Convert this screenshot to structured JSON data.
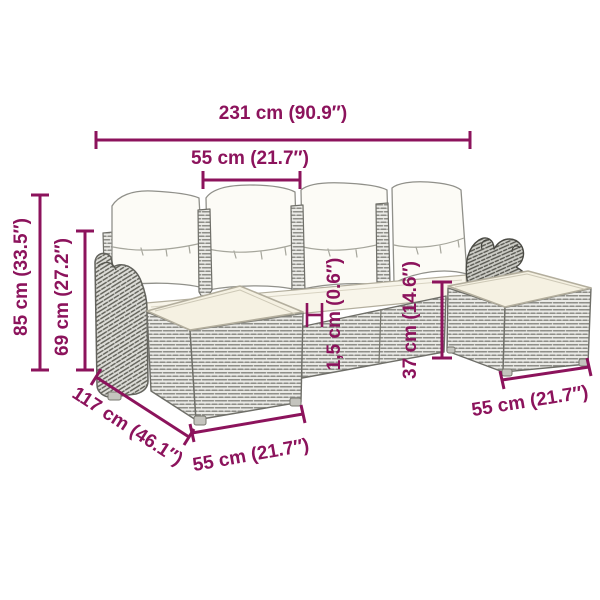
{
  "diagram": {
    "subject": "U-shaped poly rattan garden sofa set with 4 back pillows, seat cushions and 2 ottomans — dimension drawing",
    "background_color": "#ffffff",
    "accent_color": "#8C135C",
    "wicker_line_color": "#8e8e88",
    "cushion_color": "#f5f1e2",
    "pillow_color": "#fcfbf6"
  },
  "labels": {
    "overall_width": "231 cm (90.9″)",
    "seat_width": "55 cm (21.7″)",
    "total_height": "85 cm (33.5″)",
    "back_height": "69 cm (27.2″)",
    "cushion_thickness": "1,5 cm (0.6″)",
    "seat_height": "37 cm (14.6″)",
    "depth": "117 cm (46.1″)",
    "ottoman_front_width": "55 cm (21.7″)",
    "ottoman_right_width": "55 cm (21.7″)"
  }
}
